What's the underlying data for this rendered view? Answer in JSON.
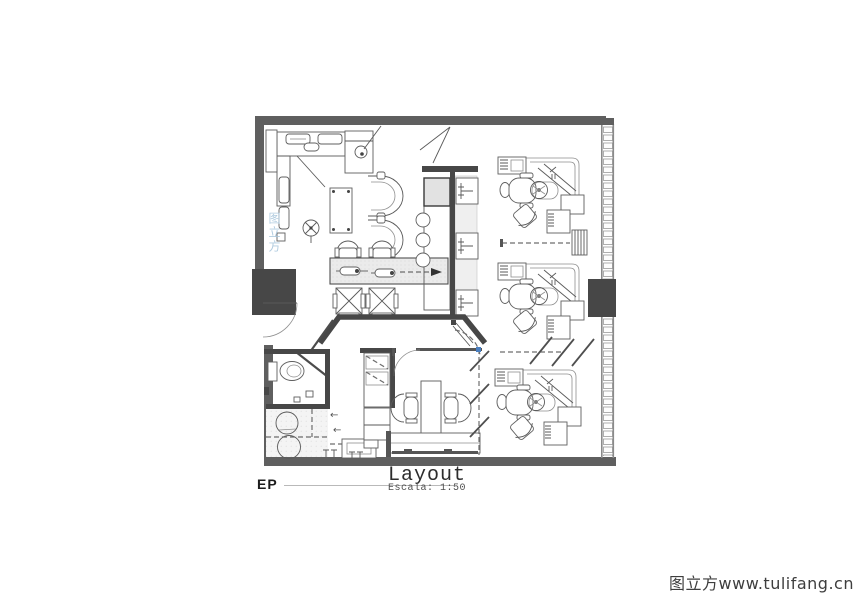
{
  "title_block": {
    "detail_tag": "EP",
    "drawing_title": "Layout",
    "scale_label": "Escala: 1:50"
  },
  "watermarks": {
    "corner_text": "图立方www.tulifang.cn",
    "plan_text": "图立方"
  },
  "annotations": {
    "arrow_note_1": "←",
    "arrow_note_2": "←"
  },
  "drawing": {
    "type": "floor-plan",
    "scale": "1:50",
    "title": "Layout",
    "rooms": [
      {
        "name": "pantry-office"
      },
      {
        "name": "waiting-lounge"
      },
      {
        "name": "reception"
      },
      {
        "name": "toilet"
      },
      {
        "name": "utility-sterilization"
      },
      {
        "name": "consultation-office"
      },
      {
        "name": "treatment-area"
      }
    ],
    "fixtures": {
      "dental_stations": 3,
      "lounge_chairs": 2,
      "reception_chairs": 4,
      "stools": 3,
      "toilets": 1,
      "sinks": 3,
      "columns": 2
    }
  },
  "colors": {
    "wall": "#5f5f5f",
    "column": "#474747",
    "cad_line": "#5a5a5a",
    "hatch_fill": "#ebebeb",
    "plan_watermark_blue": "#a9c7dd",
    "corner_watermark_gray": "#3e3e3e",
    "accent_blue": "#4a7fc1"
  }
}
